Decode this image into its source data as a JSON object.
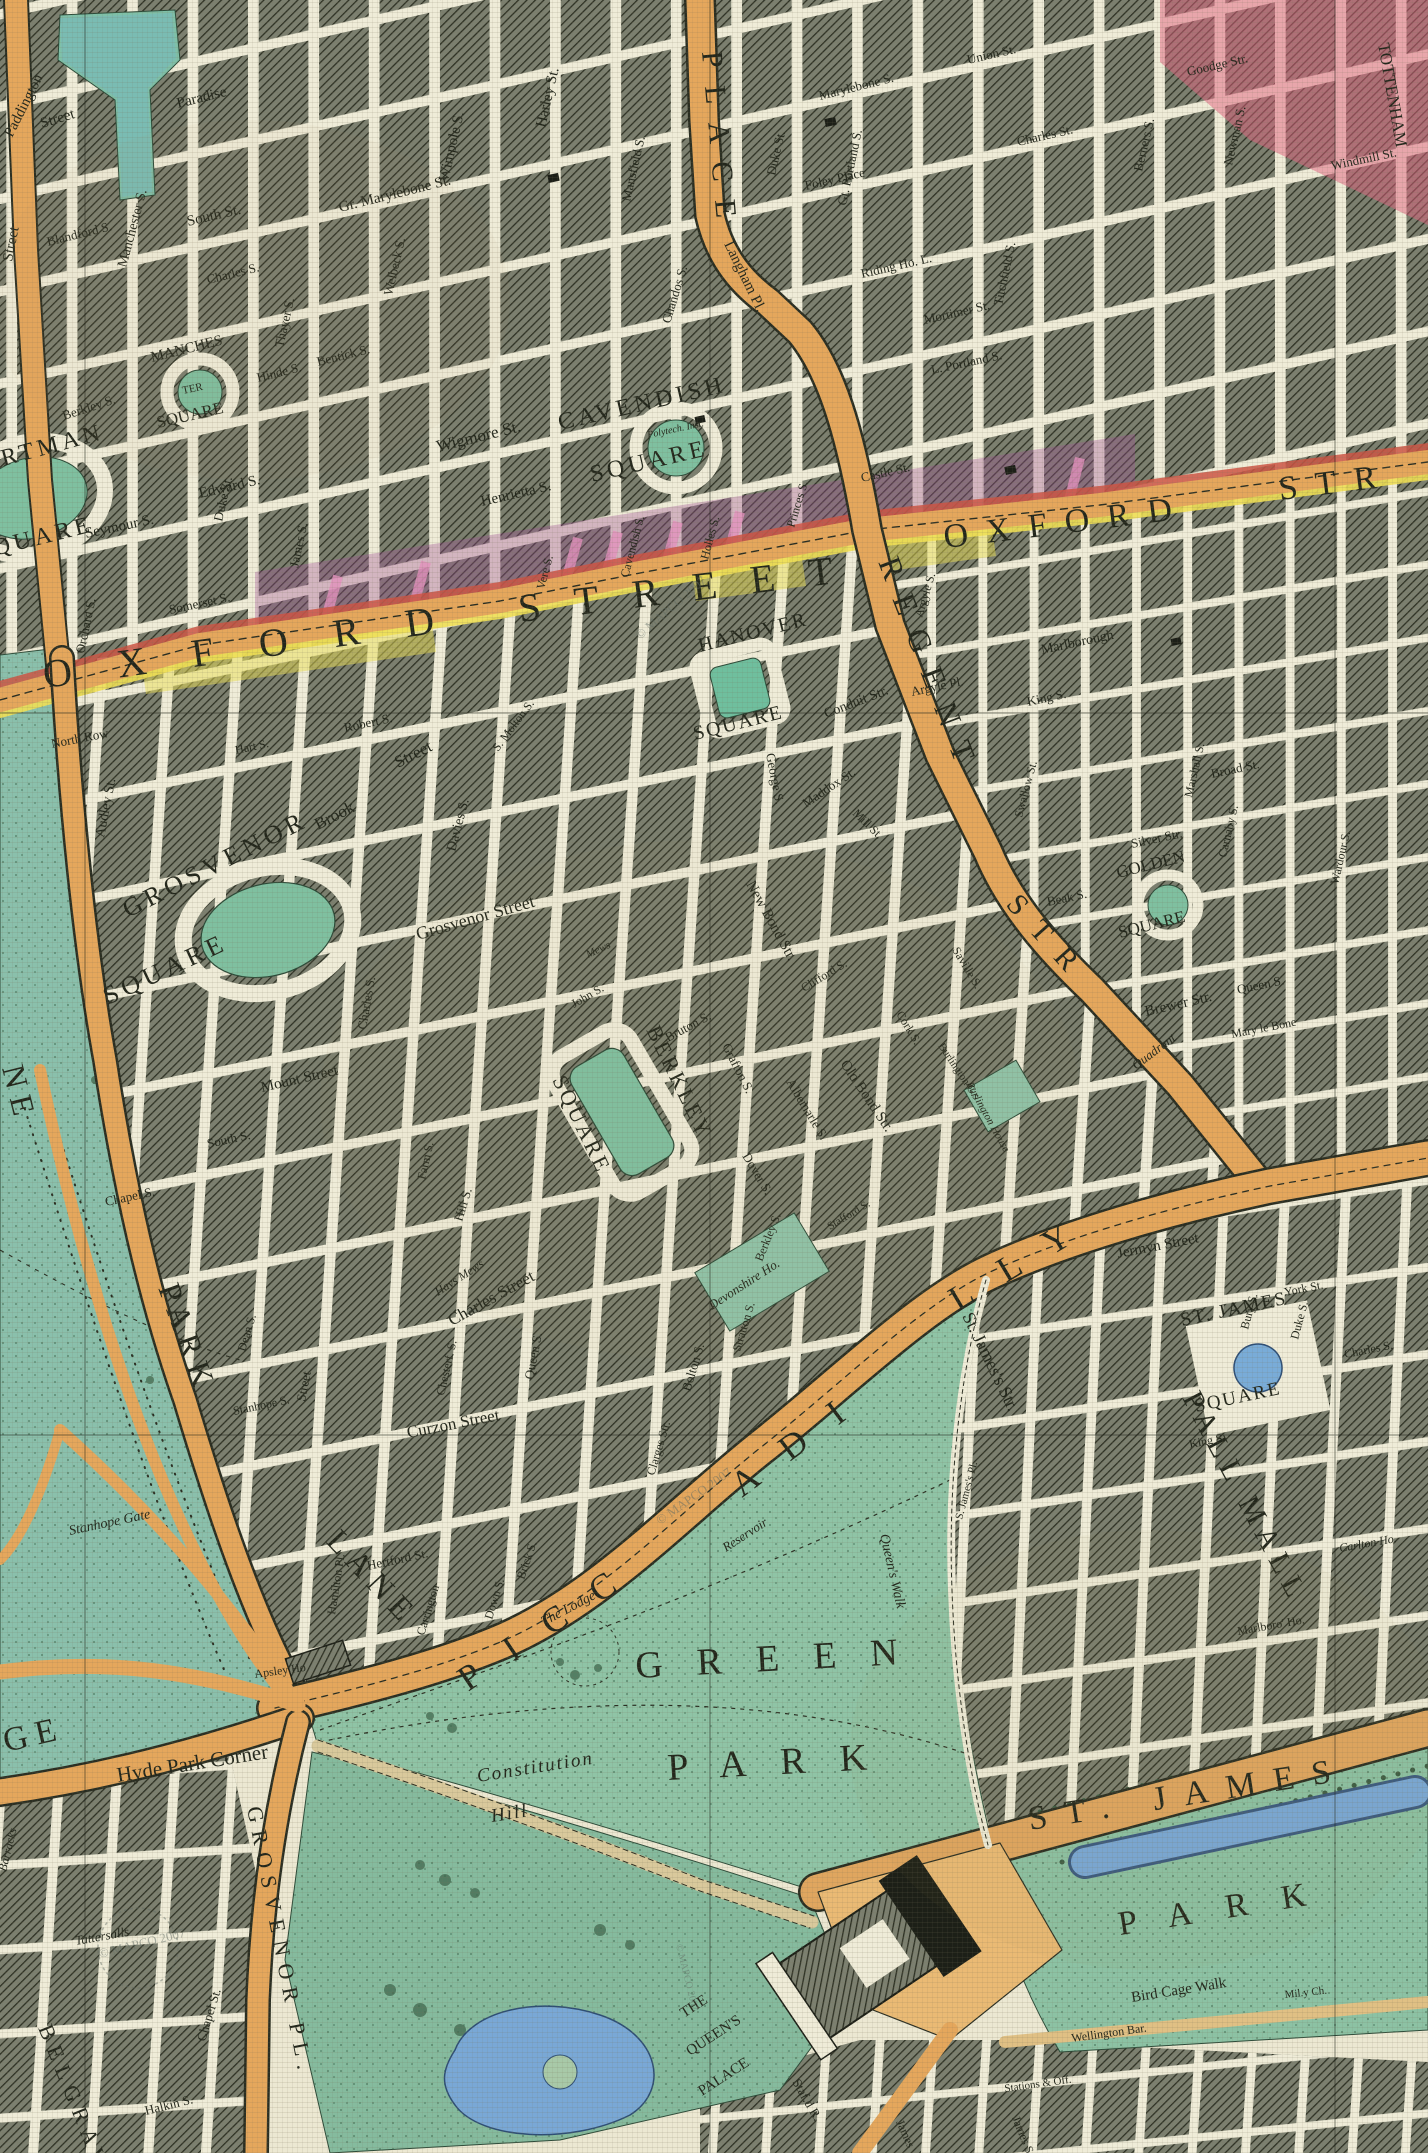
{
  "colors": {
    "paper": "#ece8d2",
    "block_hatch": "#3a3e30",
    "street": "#efecd8",
    "main_road_orange": "#e5a75c",
    "oxford_red_edge": "#cc5544",
    "oxford_yellow_edge": "#eedf55",
    "park_green": "#8cc2a8",
    "water_blue": "#79a8d6",
    "square_green": "#7fc0a0",
    "tint_purple": "#a04f96",
    "tint_pink": "#e2607d",
    "tint_yellow": "#eade52",
    "ink": "#23271c"
  },
  "labels": {
    "wm": "© MAPCO 2007",
    "ox_w1": "OXFORD",
    "ox_w2": "STREET",
    "ox_e1": "OXFORD",
    "ox_e2": "STR",
    "regent1": "REGENT",
    "regent2": "STR",
    "portland": "PLACE",
    "parklane1": "PARK",
    "parklane2": "LANE",
    "ne": "NE",
    "picc1": "PICC",
    "picc2": "ADI",
    "picc3": "LLY",
    "pallmall": "PALL MALL",
    "stjstr": "St. James's Str.",
    "grn1": "GREEN",
    "grn2": "PARK",
    "sjp1": "ST. JAMES",
    "sjp2": "PARK",
    "ge": "GE",
    "grospl": "GROSVENOR PL.",
    "belgrave": "BELGRAVE",
    "portman1": "PORTMAN",
    "portman2": "SQUARE",
    "manch1": "MANCHES",
    "manch2": "TER",
    "manch3": "SQUARE",
    "cav1": "CAVENDISH",
    "cav2": "SQUARE",
    "han1": "HANOVER",
    "han2": "SQUARE",
    "gro1": "GROSVENOR",
    "gro2": "SQUARE",
    "ber1": "BERKLEY",
    "ber2": "SQUARE",
    "gold1": "GOLDEN",
    "gold2": "SQUARE",
    "stjs1": "ST. JAMES",
    "stjs2": "SQUARE",
    "l_paddington": "Paddington",
    "l_paradise": "Paradise",
    "l_street_a": "Street",
    "l_street_b": "Street",
    "l_blandford": "Blandford S.",
    "l_manch_st": "Manchester S.",
    "l_south_st": "South St.",
    "l_charles_m": "Charles S.",
    "l_thayer": "Thayer S.",
    "l_gmary": "Gr. Marylebone St.",
    "l_wimpole": "Wimpole S.",
    "l_welbeck": "Welbeck S.",
    "l_hinde": "Hinde S.",
    "l_bentick": "Bentick S.",
    "l_berkley_m": "Berkley S.",
    "l_seymour": "Seymour S.",
    "l_edward": "Edward S.",
    "l_duke_m": "Duke St.",
    "l_james_m": "James S.",
    "l_somerset": "Somerset S.",
    "l_orchard": "Orchard S.",
    "l_wigmore": "Wigmore St.",
    "l_henrietta": "Henrietta S.",
    "l_vere": "Vere S.",
    "l_cavendish_os": "Cavendish S.",
    "l_holles": "Holles S.",
    "l_princes_h": "Princes S.",
    "l_harley": "Harley St.",
    "l_mansfield": "Mansfield S.",
    "l_chandos": "Chandos S.",
    "l_langham": "Langham Pl.",
    "l_duke_f": "Duke St.",
    "l_maryb": "Marylebone S.",
    "l_gtport": "Gt. Portland S.",
    "l_foley": "Foley Place",
    "l_riding": "Riding Ho. L.",
    "l_mortimer": "Mortimer St.",
    "l_lport": "L. Portland S.",
    "l_titch": "Titchfield S.",
    "l_union_f": "Union St.",
    "l_charles_f": "Charles St.",
    "l_berners": "Berners S.",
    "l_newman": "Newman S.",
    "l_goodge": "Goodge Str.",
    "l_tottenham": "TOTTENHAM",
    "l_windmill": "Windmill St.",
    "l_castle": "Castle St.",
    "l_argyle_s": "Argyle S.",
    "l_argyle_p": "Argyle Pl.",
    "l_northrow": "North Row",
    "l_hart": "Hart S.",
    "l_robert": "Robert S.",
    "l_audley": "Audley St.",
    "l_brook1": "Brook",
    "l_brook2": "Street",
    "l_davies": "Davies S.",
    "l_grosvst": "Grosvenor Street",
    "l_charles_g": "Charles S.",
    "l_smolton": "S. Molton S.",
    "l_mount": "Mount Street",
    "l_south_m": "South S.",
    "l_chapel_m": "Chapel S.",
    "l_dean": "Dean S.",
    "l_street_sa": "Street",
    "l_hill": "Hill S.",
    "l_farm": "Farm S.",
    "l_john": "John S.",
    "l_mews": "Mews",
    "l_hays": "Hays Mews",
    "l_charles_b": "Charles Street",
    "l_queen_b": "Queen S.",
    "l_curzon": "Curzon Street",
    "l_chester": "Chesterf. S.",
    "l_bolton": "Bolton S.",
    "l_stratton": "Stratton S.",
    "l_berkley_st": "Berkley S.",
    "l_clarges": "Clarges Str.",
    "l_down": "Down S.",
    "l_brick": "Brick S.",
    "l_carrington": "Carrington",
    "l_hertford": "Hertford St.",
    "l_hamilton": "Hamilton Pl.",
    "l_stanhope_s": "Stanhope S.",
    "l_devon": "Devonshire Ho.",
    "l_lodge": "The Lodge",
    "l_hpc": "Hyde Park Corner",
    "l_apsley": "Apsley Ho",
    "l_tatt": "Tattersalls",
    "l_barracks": "Barracks",
    "l_stanhope_g": "Stanhope Gate",
    "l_chapel_b": "Chapel St.",
    "l_halkin": "Halkin S.",
    "l_const1": "Constitution",
    "l_const2": "Hill",
    "l_qwalk": "Queen's Walk",
    "l_reservoir": "Reservoir",
    "l_bird": "Bird Cage Walk",
    "l_mil": "Mil.y Ch.",
    "l_wellington": "Wellington Bar.",
    "l_stations": "Stations & Off.",
    "l_james_b": "James S.",
    "l_james_p": "James",
    "l_stafford_r": "Staf.d R.",
    "l_qp1": "THE",
    "l_qp2": "QUEEN'S",
    "l_qp3": "PALACE",
    "l_marlboro": "Marlboro' Ho.",
    "l_carlton": "Carlton Ho.",
    "l_jermyn": "Jermyn Street",
    "l_york": "York St.",
    "l_bury": "Bury S.",
    "l_duke_sj": "Duke S.",
    "l_king_sj": "King S.",
    "l_charles_sj": "Charles S.",
    "l_sjpl": "S. James's Pl.",
    "l_king_so": "King S.",
    "l_marlborough": "Marlborough",
    "l_silver": "Silver Str.",
    "l_beak": "Beak S.",
    "l_broad": "Broad St.",
    "l_marshall": "Marshall S.",
    "l_carnaby": "Carnaby S.",
    "l_swallow": "Swallow St.",
    "l_wardour": "Wardour S.",
    "l_brewer": "Brewer Str.",
    "l_queen_so": "Queen S.",
    "l_marybone": "Mary le Bone",
    "l_quadrant": "Quadrant",
    "l_conduit": "Conduit Str.",
    "l_newbond": "New Bond Str.",
    "l_oldbond": "Old Bond Str.",
    "l_albemarle": "Albemarle S.",
    "l_dover": "Dover S.",
    "l_grafton": "Grafton S.",
    "l_bruton": "Bruton S.",
    "l_clifford": "Clifford S.",
    "l_cork": "Cork S.",
    "l_savile": "Saville S.",
    "l_burlg": "Burlington G.s",
    "l_burlh": "Burlington House",
    "l_stafford_s": "Stafford S.",
    "l_maddox": "Maddox St.",
    "l_mill": "Mill St.",
    "l_george": "George S.",
    "l_poly": "Polytech. Inst."
  }
}
